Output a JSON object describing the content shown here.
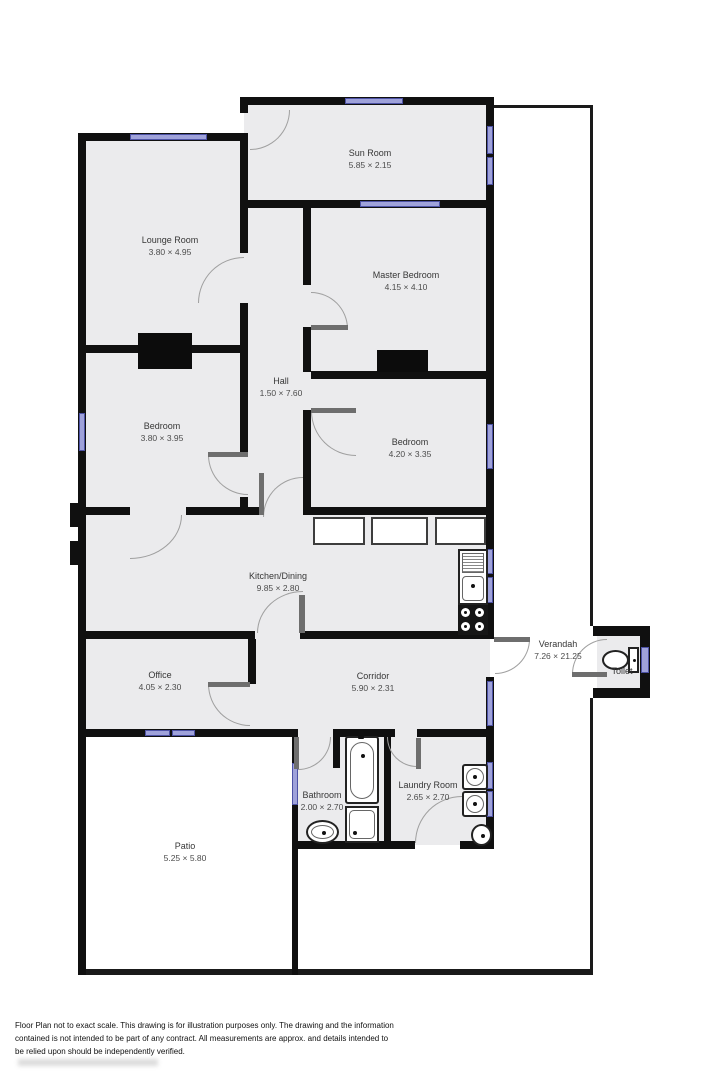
{
  "title": "Floor Plan",
  "rooms": [
    {
      "name": "Sun Room",
      "dims": "5.85 × 2.15"
    },
    {
      "name": "Lounge Room",
      "dims": "3.80 × 4.95"
    },
    {
      "name": "Master Bedroom",
      "dims": "4.15 × 4.10"
    },
    {
      "name": "Hall",
      "dims": "1.50 × 7.60"
    },
    {
      "name": "Bedroom",
      "dims": "3.80 × 3.95"
    },
    {
      "name": "Bedroom",
      "dims": "4.20 × 3.35"
    },
    {
      "name": "Kitchen/Dining",
      "dims": "9.85 × 2.80"
    },
    {
      "name": "Office",
      "dims": "4.05 × 2.30"
    },
    {
      "name": "Corridor",
      "dims": "5.90 × 2.31"
    },
    {
      "name": "Verandah",
      "dims": "7.26 × 21.25"
    },
    {
      "name": "Toilet",
      "dims": ""
    },
    {
      "name": "Bathroom",
      "dims": "2.00 × 2.70"
    },
    {
      "name": "Laundry Room",
      "dims": "2.65 × 2.70"
    },
    {
      "name": "Patio",
      "dims": "5.25 × 5.80"
    }
  ],
  "fixtures": [
    "bathtub",
    "shower",
    "bathroom-sink",
    "laundry-tub",
    "laundry-tub",
    "laundry-sink",
    "kitchen-sink",
    "stove",
    "toilet"
  ],
  "colors": {
    "wall": "#101010",
    "room_fill": "#ebebed",
    "window": "#9fa2da",
    "window_frame": "#4d52a5",
    "door_leaf": "#6e6e6e",
    "arc": "#9f9f9f"
  },
  "disclaimer": "Floor Plan not to exact scale. This drawing is for illustration purposes only. The drawing and the information contained is not intended to be part of any contract. All measurements are approx. and details intended to be relied upon should be independently verified."
}
